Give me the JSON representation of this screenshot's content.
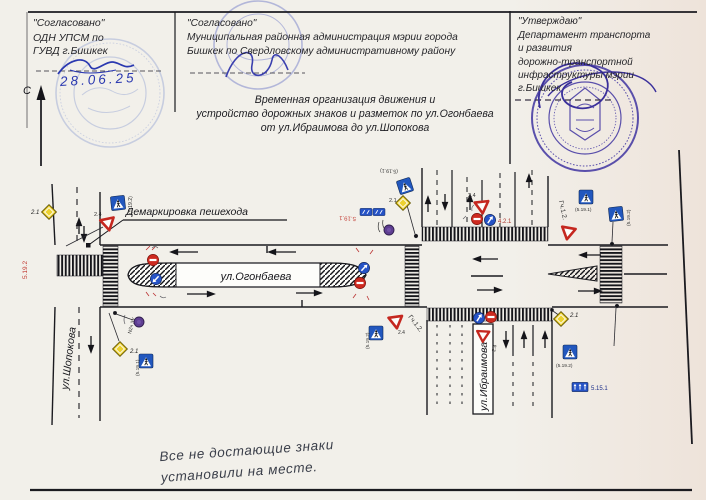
{
  "header": {
    "left": {
      "status": "\"Согласовано\"",
      "line1": "ОДН УПСМ по",
      "line2": "ГУВД г.Бишкек",
      "date": "28.06.25"
    },
    "center": {
      "status": "\"Согласовано\"",
      "line1": "Муниципальная районная администрация мэрии города",
      "line2": "Бишкек по Свердловскому административному району"
    },
    "right": {
      "status": "\"Утверждаю\"",
      "line1": "Департамент транспорта",
      "line2": "и развития",
      "line3": "дорожно-транспортной",
      "line4": "инфраструктуры мэрии",
      "line5": "г.Бишкек"
    },
    "north_label": "С"
  },
  "title": {
    "line1": "Временная организация движения и",
    "line2": "устройство дорожных знаков и разметок по ул.Огонбаева",
    "line3": "от ул.Ибраимова до ул.Шопокова"
  },
  "diagram": {
    "street_horizontal": "ул.Огонбаева",
    "street_left": "ул.Шопокова",
    "street_right": "ул.Ибраимова",
    "demarcation_label": "Демаркировка пешехода",
    "codes": {
      "c21": "2.1",
      "c24": "2.4",
      "c421": "4.2.1",
      "gch12": "Гч.1.2.",
      "p5191": "(5.19.1)",
      "p5192": "(5.19.2)",
      "r5191": "5.19.1",
      "r5192": "5.19.2",
      "s5151": "5.15.1",
      "n2ch": "N2ч ЗУ"
    }
  },
  "note": {
    "line1": "Все не достающие знаки",
    "line2": "установили на месте."
  },
  "colors": {
    "sign_blue": "#2257be",
    "sign_yellow": "#ecd12f",
    "sign_red": "#ce2a20",
    "stamp_blue": "#4a3fa5",
    "ink_blue": "#2a38b0"
  }
}
